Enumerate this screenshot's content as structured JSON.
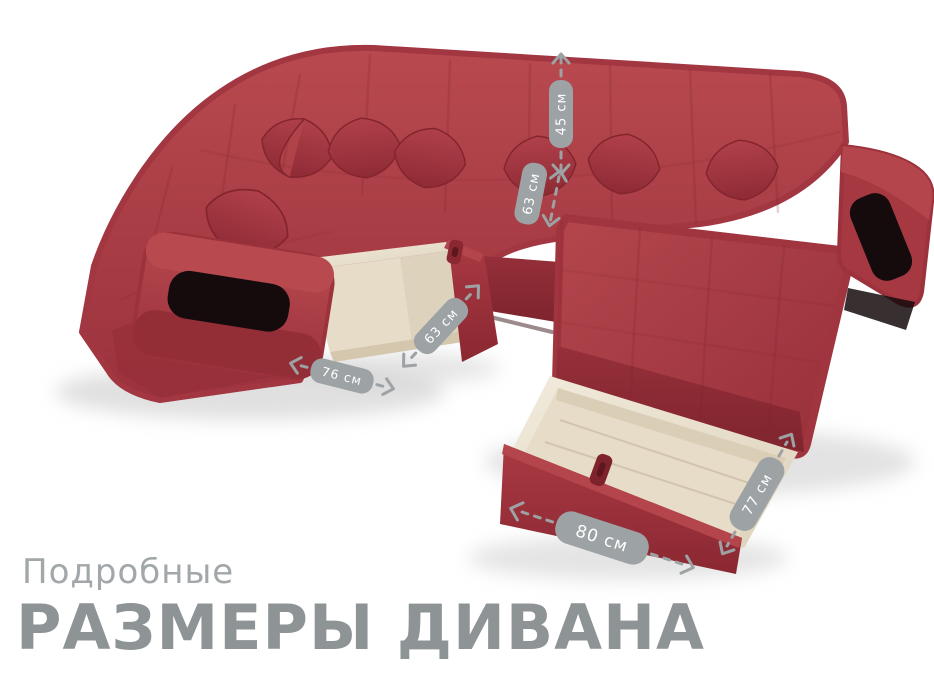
{
  "title": {
    "subtitle": "Подробные",
    "heading": "РАЗМЕРЫ ДИВАНА"
  },
  "measurements": [
    {
      "id": "backrest-height",
      "label": "45 см",
      "orientation": "vertical"
    },
    {
      "id": "seat-depth",
      "label": "63 см",
      "orientation": "diagonal"
    },
    {
      "id": "left-drawer-depth",
      "label": "63 см",
      "orientation": "diagonal"
    },
    {
      "id": "left-drawer-width",
      "label": "76 см",
      "orientation": "horizontal"
    },
    {
      "id": "front-drawer-width",
      "label": "80 см",
      "orientation": "horizontal"
    },
    {
      "id": "front-drawer-depth",
      "label": "77 см",
      "orientation": "diagonal"
    }
  ],
  "colors": {
    "background": "#ffffff",
    "sofa_red": "#a93841",
    "sofa_red_light": "#b8494f",
    "sofa_red_dark": "#8c2a33",
    "drawer_interior_beige": "#e6dcc8",
    "niche_black": "#150b0d",
    "label_bg": "#9da2a5",
    "label_text": "#ffffff",
    "subtitle_color": "#a2a7aa",
    "heading_color": "#8e9396"
  }
}
